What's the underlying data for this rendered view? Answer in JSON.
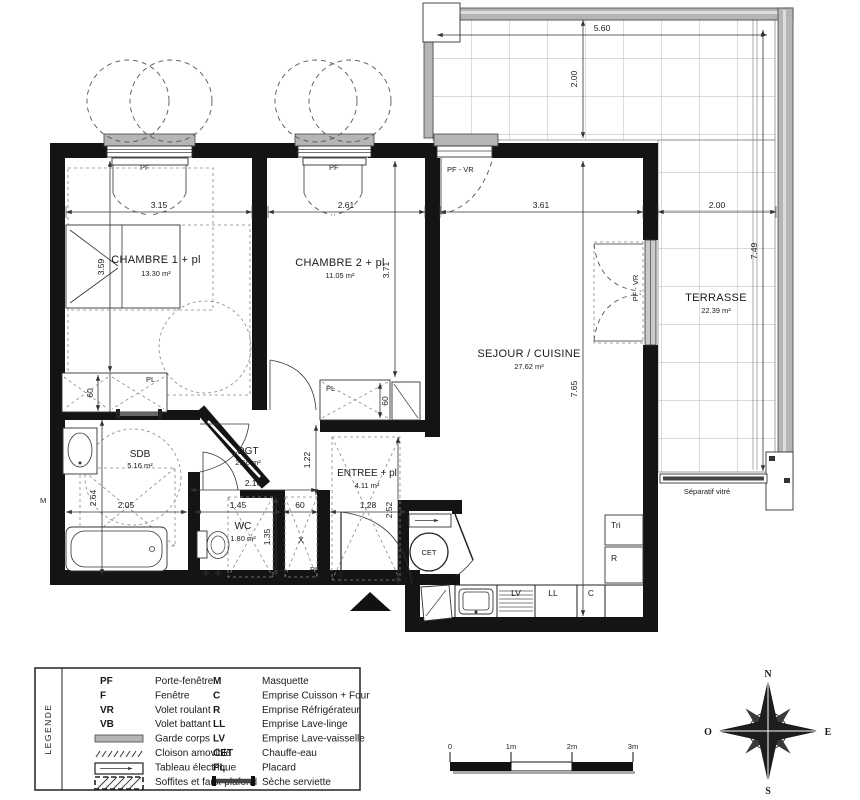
{
  "rooms": {
    "chambre1": {
      "name": "CHAMBRE 1 + pl",
      "area": "13.30 m²"
    },
    "chambre2": {
      "name": "CHAMBRE 2 + pl",
      "area": "11.05 m²"
    },
    "sejour": {
      "name": "SEJOUR / CUISINE",
      "area": "27.62 m²"
    },
    "terrasse": {
      "name": "TERRASSE",
      "area": "22.39 m²"
    },
    "sdb": {
      "name": "SDB",
      "area": "5.16 m²"
    },
    "dgt": {
      "name": "DGT",
      "area": "2.56 m²"
    },
    "wc": {
      "name": "WC",
      "area": "1.80 m²"
    },
    "entree": {
      "name": "ENTREE + pl",
      "area": "4.11 m²"
    }
  },
  "dims": {
    "chambre1_w": "3.15",
    "chambre2_w": "2.61",
    "sejour_w": "3.61",
    "terrasse_e_w": "2.00",
    "terrasse_top_w": "5.60",
    "terrasse_top_h": "2.00",
    "terrasse_e_h": "7.49",
    "chambre1_h": "3.59",
    "chambre2_h": "3.71",
    "sejour_h": "7.65",
    "sdb_h": "2.64",
    "sdb_w": "2.05",
    "wc_w": "1.45",
    "gaine_w": "60",
    "entree_w": "1.28",
    "entree_h": "2.52",
    "passage_h": "1.22",
    "wc_h": "1.35",
    "dgt_w": "2.16",
    "placard1_d": "60",
    "placard2_d": "60"
  },
  "labels": {
    "pf": "PF",
    "pf_vr": "PF - VR",
    "pl": "PL",
    "m": "M",
    "x": "X",
    "cet": "CET",
    "tri": "Tri",
    "r": "R",
    "lv": "LV",
    "ll": "LL",
    "c": "C",
    "separatif": "Séparatif vitré"
  },
  "legend": {
    "title": "LEGENDE",
    "left": [
      {
        "abbr": "PF",
        "label": "Porte-fenêtre"
      },
      {
        "abbr": "F",
        "label": "Fenêtre"
      },
      {
        "abbr": "VR",
        "label": "Volet roulant"
      },
      {
        "abbr": "VB",
        "label": "Volet battant"
      },
      {
        "abbr": "",
        "label": "Garde corps"
      },
      {
        "abbr": "",
        "label": "Cloison amovible"
      },
      {
        "abbr": "",
        "label": "Tableau électrique"
      },
      {
        "abbr": "",
        "label": "Soffites et faux-plafond"
      }
    ],
    "right": [
      {
        "abbr": "M",
        "label": "Masquette"
      },
      {
        "abbr": "C",
        "label": "Emprise Cuisson + Four"
      },
      {
        "abbr": "R",
        "label": "Emprise Réfrigérateur"
      },
      {
        "abbr": "LL",
        "label": "Emprise Lave-linge"
      },
      {
        "abbr": "LV",
        "label": "Emprise Lave-vaisselle"
      },
      {
        "abbr": "CET",
        "label": "Chauffe-eau"
      },
      {
        "abbr": "PL",
        "label": "Placard"
      },
      {
        "abbr": "",
        "label": "Sèche serviette"
      }
    ]
  },
  "scalebar": {
    "t0": "0",
    "t1": "1m",
    "t2": "2m",
    "t3": "3m"
  },
  "compass": {
    "n": "N",
    "s": "S",
    "e": "E",
    "o": "O"
  },
  "colors": {
    "wall": "#141414",
    "garde_corps": "#b5b5b5",
    "grid": "#9a9a9a"
  }
}
